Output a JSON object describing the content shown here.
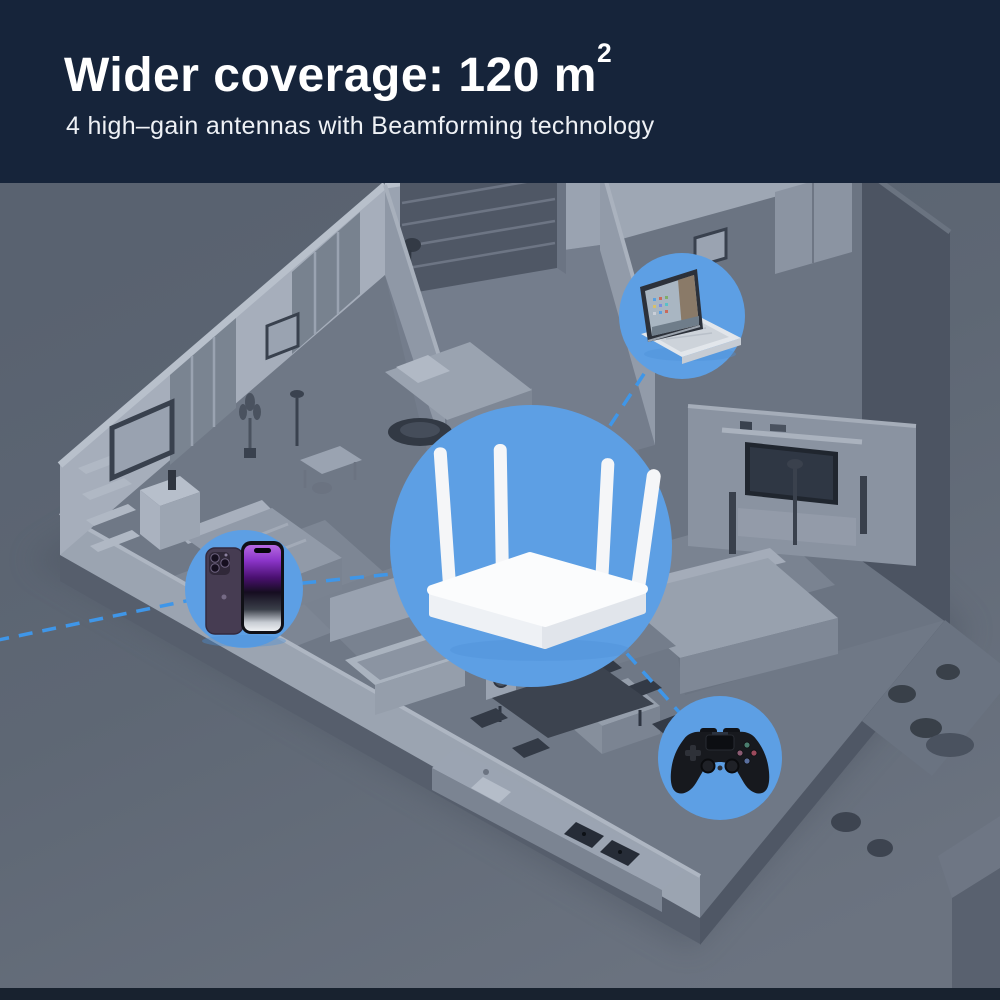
{
  "header": {
    "title_main": "Wider coverage: 120 m",
    "title_sup": "2",
    "subtitle": "4 high–gain antennas with Beamforming technology",
    "background_color": "#16243a",
    "text_color": "#ffffff"
  },
  "scene": {
    "background_color": "#5f6876",
    "illustration": "isometric-apartment-floorplan",
    "signal_line_color": "#3f96e8",
    "hotspot_color": "#5d9fe4",
    "hotspots": [
      {
        "id": "router",
        "icon": "wifi-router-icon",
        "device": "Wi-Fi router with 4 antennas"
      },
      {
        "id": "laptop",
        "icon": "laptop-icon",
        "device": "Laptop"
      },
      {
        "id": "phone",
        "icon": "smartphone-icon",
        "device": "Smartphone"
      },
      {
        "id": "controller",
        "icon": "game-controller-icon",
        "device": "Game controller"
      }
    ]
  },
  "footer": {
    "strip_color": "#18222f"
  }
}
